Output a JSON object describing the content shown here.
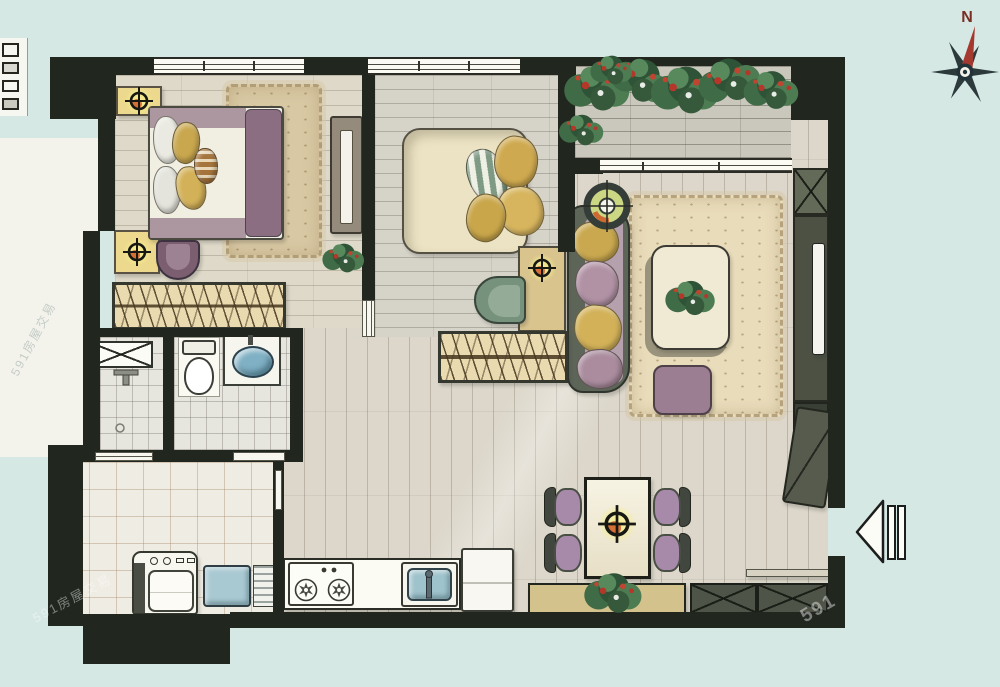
{
  "document": {
    "type": "apartment floor plan",
    "style": "hand-rendered watercolor plan, no room labels"
  },
  "compass": {
    "label": "N"
  },
  "watermarks": {
    "bottom_left": "591房屋交易",
    "bottom_right": "591",
    "side": "591房屋交易"
  },
  "palette": {
    "background": "#d6e8e4",
    "walls": "#21261f",
    "wood_floor": "#dcd7ca",
    "bedroom_floor": "#ded9c9",
    "deck": "#cac7bc",
    "tile": "#e6e5de",
    "laundry_tile": "#eeece3",
    "rug": "#e8d9b8",
    "closet": "#e9dab0",
    "gold_pillow": "#cfa94f",
    "mauve": "#a188a0",
    "sofa_frame": "#5d6458",
    "foliage": "#3f6b46",
    "flower_red": "#b5372a",
    "water_blue": "#9fc3cc",
    "lamp_glow": "#f2e98f",
    "compass_red": "#a5392f"
  },
  "rooms": [
    {
      "name": "master-bedroom",
      "items": [
        "double bed",
        "nightstand with lamp (x2)",
        "shag area rug",
        "armchair",
        "tall side cabinet",
        "potted plant",
        "built-in wardrobe with hangers",
        "window"
      ]
    },
    {
      "name": "second-bedroom",
      "items": [
        "double bed with pillow pile",
        "nightstand with lamp",
        "lounge chair",
        "built-in wardrobe with hangers",
        "window"
      ]
    },
    {
      "name": "living-room",
      "items": [
        "sofa with cushions",
        "floor lamp",
        "coffee table with plant centerpiece",
        "shag area rug",
        "ottoman",
        "TV wall unit with X-cabinet",
        "sliding door to balcony"
      ]
    },
    {
      "name": "balcony",
      "items": [
        "wood deck",
        "flower planter row"
      ]
    },
    {
      "name": "bathroom",
      "items": [
        "shower box",
        "wall faucet",
        "floor drain",
        "toilet",
        "vanity wash basin",
        "sliding door",
        "door opening"
      ]
    },
    {
      "name": "laundry-utility",
      "items": [
        "washing machine",
        "laundry sink",
        "drainboard",
        "large floor tiles"
      ]
    },
    {
      "name": "kitchen",
      "items": [
        "two-burner gas stove",
        "kitchen sink with faucet",
        "counter",
        "refrigerator"
      ]
    },
    {
      "name": "dining-area",
      "items": [
        "dining table",
        "pendant lamp",
        "four chairs with mauve seats",
        "sideboard with plant",
        "shoe cabinets with X marks"
      ]
    },
    {
      "name": "entry",
      "items": [
        "open entry door leaf",
        "threshold strip",
        "entry direction arrow pointing left"
      ]
    }
  ],
  "annotations": {
    "north_indicator": "compass rose, top-right, red needle toward N",
    "entry_arrow_direction": "left",
    "top_left_edge": "partial mini key-plan sliver"
  }
}
